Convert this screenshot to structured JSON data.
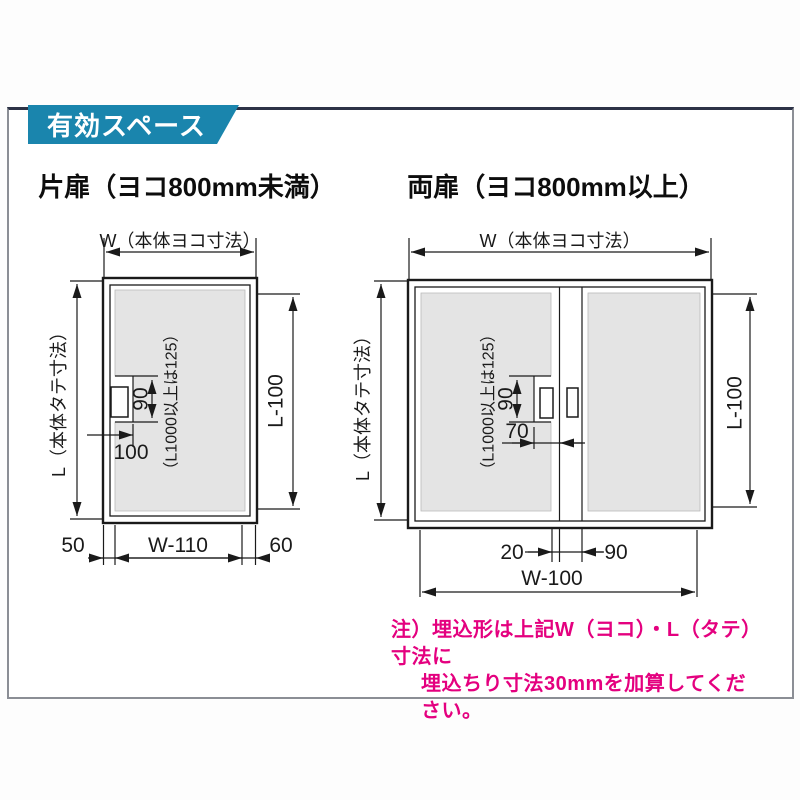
{
  "header": {
    "title": "有効スペース"
  },
  "single": {
    "title": "片扉（ヨコ800mm未満）",
    "dim_w": "W（本体ヨコ寸法）",
    "dim_l": "L（本体タテ寸法）",
    "dim_l100": "L-100",
    "dim_90": "90",
    "dim_100": "100",
    "dim_tall": "（L1000以上は125）",
    "dim_50": "50",
    "dim_opening": "W-110",
    "dim_60": "60"
  },
  "double": {
    "title": "両扉（ヨコ800mm以上）",
    "dim_w": "W（本体ヨコ寸法）",
    "dim_l": "L（本体タテ寸法）",
    "dim_l100": "L-100",
    "dim_90": "90",
    "dim_70": "70",
    "dim_tall": "（L1000以上は125）",
    "dim_20": "20",
    "dim_90b": "90",
    "dim_opening": "W-100"
  },
  "note": {
    "line1": "注）埋込形は上記W（ヨコ）・L（タテ）寸法に",
    "line2": "埋込ちり寸法30mmを加算してください。"
  },
  "colors": {
    "accent": "#1a85ad",
    "note_pink": "#e4007f",
    "effective_area_gray": "#e4e4e4",
    "line": "#1a1a1a"
  }
}
